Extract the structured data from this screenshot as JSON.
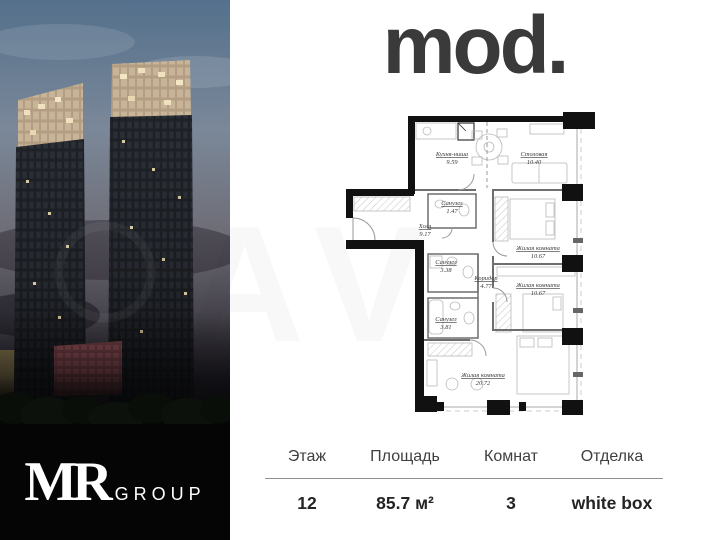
{
  "photo": {
    "developer_name": "MR",
    "developer_suffix": "GROUP"
  },
  "brand": {
    "logo": "mod."
  },
  "watermark": {
    "text": "AV"
  },
  "plan": {
    "rooms": [
      {
        "name": "Кухня-ниша",
        "area": "9.59"
      },
      {
        "name": "Столовая",
        "area": "10.40"
      },
      {
        "name": "Санузел",
        "area": "1.47"
      },
      {
        "name": "Холл",
        "area": "9.17"
      },
      {
        "name": "Жилая комната",
        "area": "10.67"
      },
      {
        "name": "Санузел",
        "area": "3.38"
      },
      {
        "name": "Коридор",
        "area": "4.77"
      },
      {
        "name": "Жилая комната",
        "area": "10.67"
      },
      {
        "name": "Санузел",
        "area": "3.81"
      },
      {
        "name": "Жилая комната",
        "area": "20.72"
      }
    ]
  },
  "details": {
    "columns": [
      {
        "label": "Этаж",
        "value": "12"
      },
      {
        "label": "Площадь",
        "value": "85.7 м²"
      },
      {
        "label": "Комнат",
        "value": "3"
      },
      {
        "label": "Отделка",
        "value": "white box"
      }
    ]
  },
  "colors": {
    "wall_black": "#111111",
    "panel_black": "#050506",
    "logo_gray": "#3a3a3a",
    "crown_beige": "#c8b498",
    "facade_dark": "#24272d",
    "accent_red_building": "#84494f"
  }
}
